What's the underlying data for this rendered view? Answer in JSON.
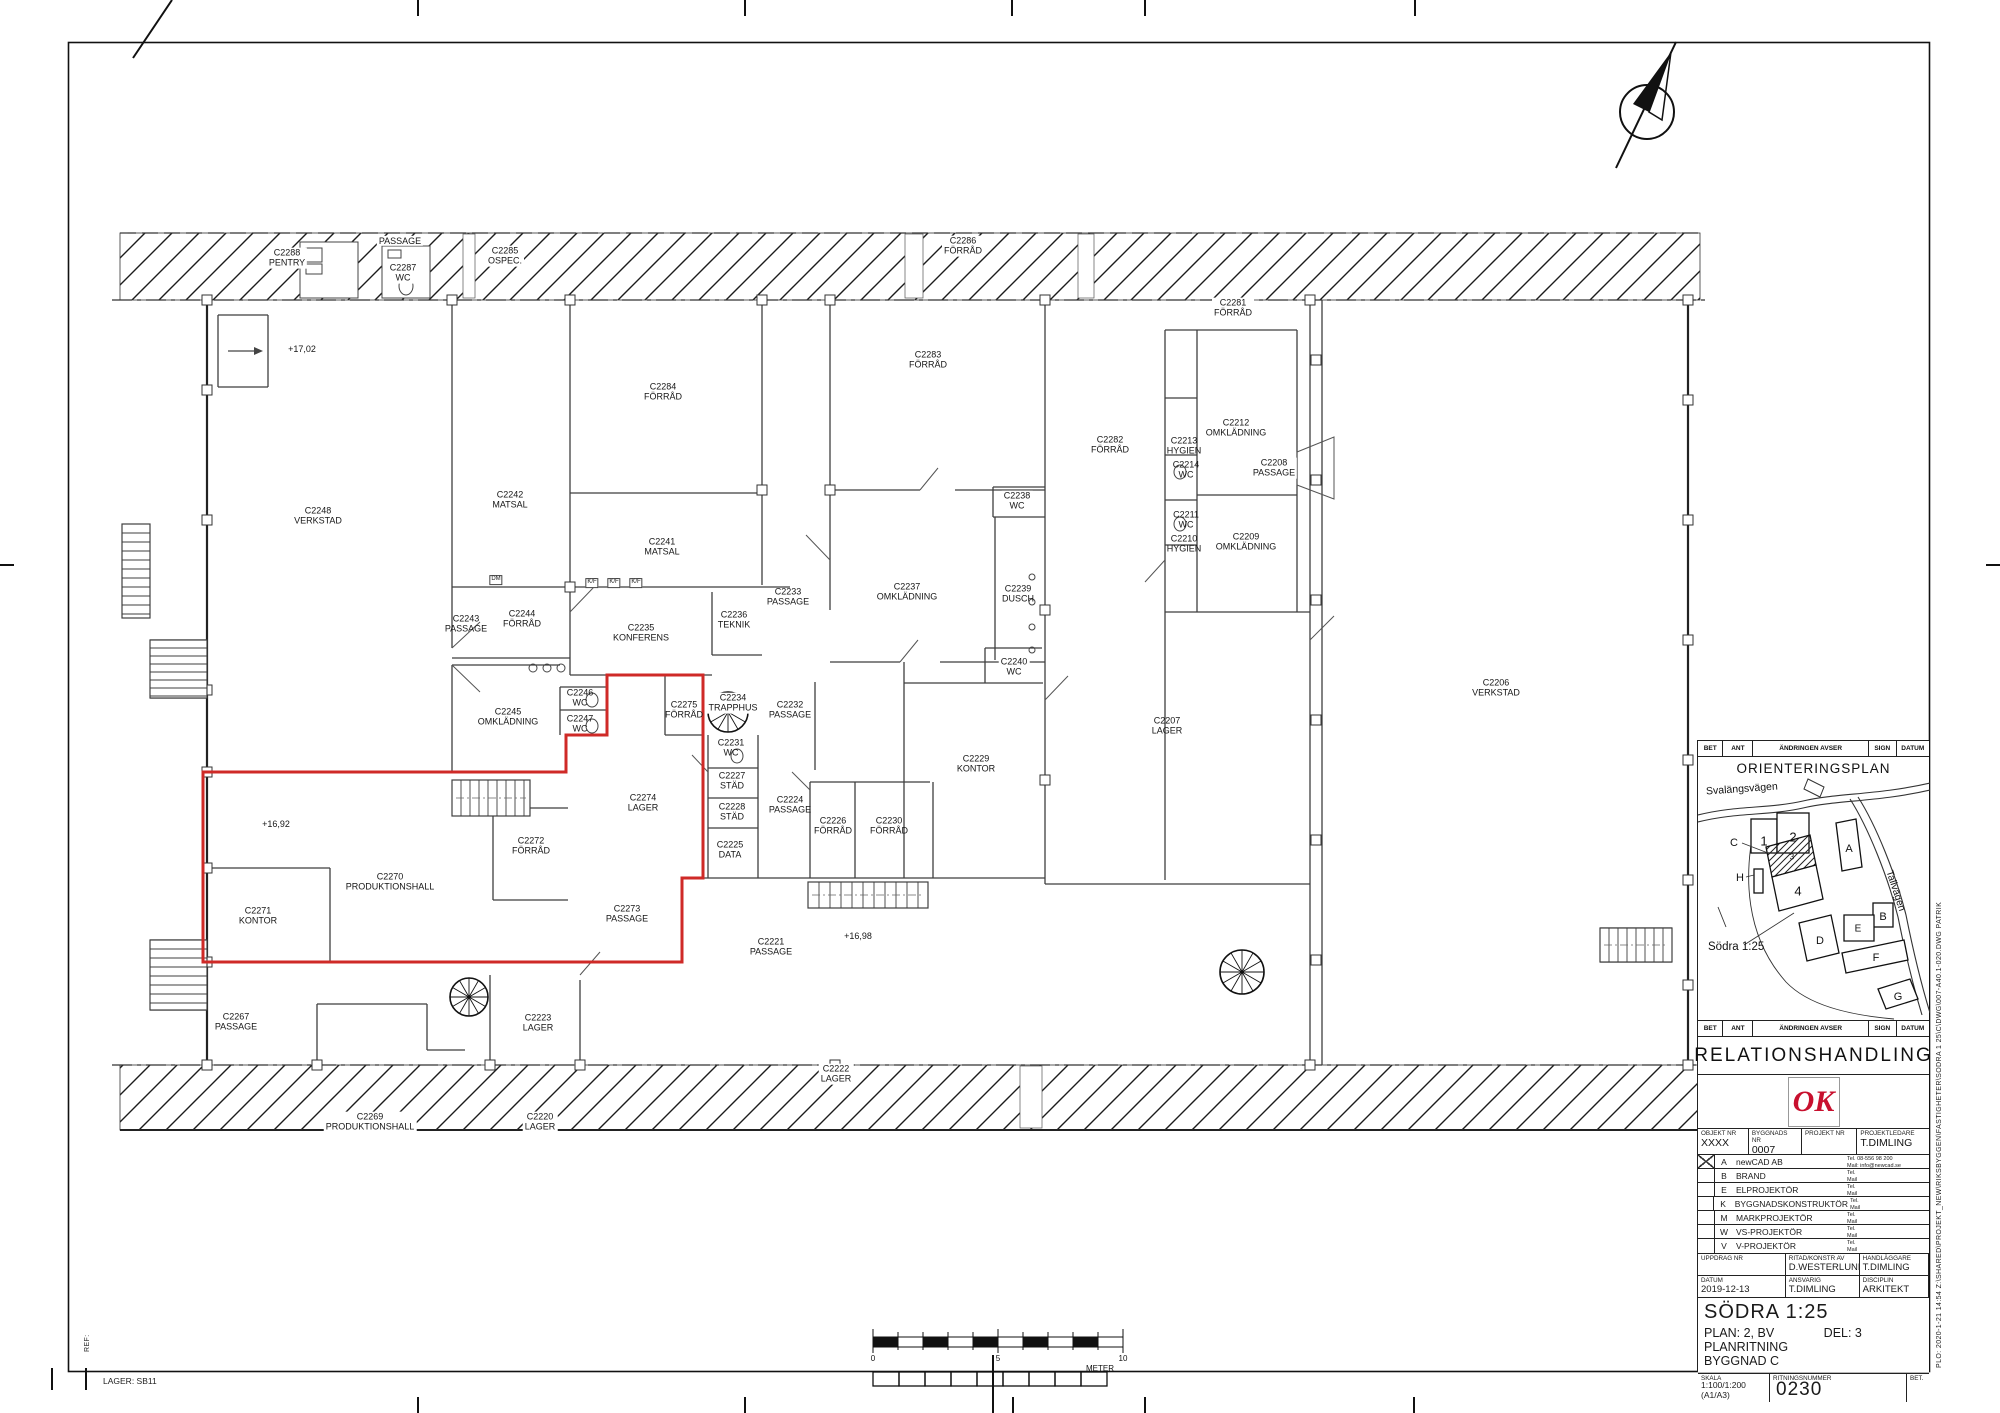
{
  "colors": {
    "highlight": "#cf2a27",
    "ok_red": "#c8102e",
    "wall": "#3f3f3f"
  },
  "rooms": [
    {
      "id": "C2288",
      "name": "PENTRY",
      "x": 287,
      "y": 258,
      "bg": true
    },
    {
      "id": "",
      "name": "PASSAGE",
      "x": 400,
      "y": 241,
      "bg": true
    },
    {
      "id": "C2287",
      "name": "WC",
      "x": 403,
      "y": 273,
      "bg": true
    },
    {
      "id": "C2285",
      "name": "OSPEC.",
      "x": 505,
      "y": 256,
      "bg": true
    },
    {
      "id": "C2286",
      "name": "FÖRRÅD",
      "x": 963,
      "y": 246,
      "bg": true
    },
    {
      "id": "C2281",
      "name": "FÖRRÅD",
      "x": 1233,
      "y": 308,
      "bg": true
    },
    {
      "id": "C2284",
      "name": "FÖRRÅD",
      "x": 663,
      "y": 392
    },
    {
      "id": "C2283",
      "name": "FÖRRÅD",
      "x": 928,
      "y": 360
    },
    {
      "id": "C2282",
      "name": "FÖRRÅD",
      "x": 1110,
      "y": 445
    },
    {
      "id": "C2248",
      "name": "VERKSTAD",
      "x": 318,
      "y": 516
    },
    {
      "id": "C2242",
      "name": "MATSAL",
      "x": 510,
      "y": 500
    },
    {
      "id": "C2241",
      "name": "MATSAL",
      "x": 662,
      "y": 547
    },
    {
      "id": "C2243",
      "name": "PASSAGE",
      "x": 466,
      "y": 624
    },
    {
      "id": "C2244",
      "name": "FÖRRÅD",
      "x": 522,
      "y": 619
    },
    {
      "id": "C2235",
      "name": "KONFERENS",
      "x": 641,
      "y": 633
    },
    {
      "id": "C2236",
      "name": "TEKNIK",
      "x": 734,
      "y": 620
    },
    {
      "id": "C2233",
      "name": "PASSAGE",
      "x": 788,
      "y": 597
    },
    {
      "id": "C2237",
      "name": "OMKLÄDNING",
      "x": 907,
      "y": 592
    },
    {
      "id": "C2239",
      "name": "DUSCH",
      "x": 1018,
      "y": 594
    },
    {
      "id": "C2238",
      "name": "WC",
      "x": 1017,
      "y": 501,
      "bg": true
    },
    {
      "id": "C2240",
      "name": "WC",
      "x": 1014,
      "y": 667,
      "bg": true
    },
    {
      "id": "C2213",
      "name": "HYGIEN",
      "x": 1184,
      "y": 446
    },
    {
      "id": "C2212",
      "name": "OMKLÄDNING",
      "x": 1236,
      "y": 428
    },
    {
      "id": "C2214",
      "name": "WC",
      "x": 1186,
      "y": 470
    },
    {
      "id": "C2208",
      "name": "PASSAGE",
      "x": 1274,
      "y": 468,
      "bg": true
    },
    {
      "id": "C2211",
      "name": "WC",
      "x": 1186,
      "y": 520
    },
    {
      "id": "C2210",
      "name": "HYGIEN",
      "x": 1184,
      "y": 544
    },
    {
      "id": "C2209",
      "name": "OMKLÄDNING",
      "x": 1246,
      "y": 542
    },
    {
      "id": "C2206",
      "name": "VERKSTAD",
      "x": 1496,
      "y": 688
    },
    {
      "id": "C2207",
      "name": "LAGER",
      "x": 1167,
      "y": 726
    },
    {
      "id": "C2229",
      "name": "KONTOR",
      "x": 976,
      "y": 764
    },
    {
      "id": "C2245",
      "name": "OMKLÄDNING",
      "x": 508,
      "y": 717
    },
    {
      "id": "C2246",
      "name": "WC",
      "x": 580,
      "y": 698
    },
    {
      "id": "C2247",
      "name": "WC",
      "x": 580,
      "y": 724
    },
    {
      "id": "C2275",
      "name": "FÖRRÅD",
      "x": 684,
      "y": 710
    },
    {
      "id": "C2234",
      "name": "TRAPPHUS",
      "x": 733,
      "y": 703,
      "bg": true
    },
    {
      "id": "C2231",
      "name": "WC",
      "x": 731,
      "y": 748
    },
    {
      "id": "C2227",
      "name": "STÄD",
      "x": 732,
      "y": 781
    },
    {
      "id": "C2228",
      "name": "STÄD",
      "x": 732,
      "y": 812
    },
    {
      "id": "C2225",
      "name": "DATA",
      "x": 730,
      "y": 850
    },
    {
      "id": "C2232",
      "name": "PASSAGE",
      "x": 790,
      "y": 710
    },
    {
      "id": "C2224",
      "name": "PASSAGE",
      "x": 790,
      "y": 805
    },
    {
      "id": "C2226",
      "name": "FÖRRÅD",
      "x": 833,
      "y": 826
    },
    {
      "id": "C2230",
      "name": "FÖRRÅD",
      "x": 889,
      "y": 826
    },
    {
      "id": "C2274",
      "name": "LAGER",
      "x": 643,
      "y": 803
    },
    {
      "id": "C2272",
      "name": "FÖRRÅD",
      "x": 531,
      "y": 846
    },
    {
      "id": "C2270",
      "name": "PRODUKTIONSHALL",
      "x": 390,
      "y": 882
    },
    {
      "id": "C2271",
      "name": "KONTOR",
      "x": 258,
      "y": 916
    },
    {
      "id": "C2273",
      "name": "PASSAGE",
      "x": 627,
      "y": 914
    },
    {
      "id": "C2221",
      "name": "PASSAGE",
      "x": 771,
      "y": 947
    },
    {
      "id": "C2267",
      "name": "PASSAGE",
      "x": 236,
      "y": 1022
    },
    {
      "id": "C2223",
      "name": "LAGER",
      "x": 538,
      "y": 1023
    },
    {
      "id": "C2222",
      "name": "LAGER",
      "x": 836,
      "y": 1074,
      "bg": true
    },
    {
      "id": "C2269",
      "name": "PRODUKTIONSHALL",
      "x": 370,
      "y": 1122,
      "bg": true
    },
    {
      "id": "C2220",
      "name": "LAGER",
      "x": 540,
      "y": 1122,
      "bg": true
    }
  ],
  "annotations": [
    {
      "t": "+17,02",
      "x": 302,
      "y": 349
    },
    {
      "t": "+16,92",
      "x": 276,
      "y": 824
    },
    {
      "t": "+16,98",
      "x": 858,
      "y": 936
    }
  ],
  "fixtures": [
    {
      "t": "DM",
      "x": 496,
      "y": 580
    },
    {
      "t": "K/F",
      "x": 592,
      "y": 583
    },
    {
      "t": "K/F",
      "x": 614,
      "y": 583
    },
    {
      "t": "K/F",
      "x": 636,
      "y": 583
    }
  ],
  "scalebar": {
    "zero": "0",
    "five": "5",
    "ten": "10",
    "unit": "METER"
  },
  "meta": {
    "lager": "LAGER: SB11",
    "ref": "REF:",
    "plot": "PLO:  2020-1-21   14:54    Z:\\SHARED\\PROJEKT_NEW\\RIKSBYGGEN\\FASTIGHETER\\SODRA 1 25\\C\\DWG\\007-A40.1-020.DWG    PATRIK"
  },
  "titleblock": {
    "rev_header": [
      "BET",
      "ANT",
      "ÄNDRINGEN AVSER",
      "SIGN",
      "DATUM"
    ],
    "orientation": {
      "title": "ORIENTERINGSPLAN",
      "road1": "Svalängsvägen",
      "road2": "Tallvägen",
      "area": "Södra 1:25",
      "buildings": [
        {
          "t": "1",
          "x": 66,
          "y": 84,
          "s": 13
        },
        {
          "t": "2",
          "x": 95,
          "y": 80,
          "s": 13
        },
        {
          "t": "3",
          "x": 94,
          "y": 100,
          "s": 8
        },
        {
          "t": "4",
          "x": 100,
          "y": 134,
          "s": 13
        },
        {
          "t": "A",
          "x": 151,
          "y": 92,
          "s": 11
        },
        {
          "t": "B",
          "x": 185,
          "y": 160,
          "s": 11
        },
        {
          "t": "C",
          "x": 36,
          "y": 86,
          "s": 11
        },
        {
          "t": "D",
          "x": 122,
          "y": 184,
          "s": 11
        },
        {
          "t": "E",
          "x": 160,
          "y": 172,
          "s": 10
        },
        {
          "t": "F",
          "x": 178,
          "y": 201,
          "s": 11
        },
        {
          "t": "G",
          "x": 200,
          "y": 240,
          "s": 11
        },
        {
          "t": "H",
          "x": 42,
          "y": 121,
          "s": 11
        }
      ]
    },
    "doc_type": "RELATIONSHANDLING",
    "logo": "OK",
    "fields": [
      {
        "label": "OBJEKT NR",
        "value": "XXXX"
      },
      {
        "label": "BYGGNADS NR",
        "value": "0007"
      },
      {
        "label": "PROJEKT NR",
        "value": ""
      },
      {
        "label": "PROJEKTLEDARE",
        "value": "T.DIMLING"
      }
    ],
    "consultants": [
      {
        "code": "A",
        "name": "newCAD AB",
        "tel": "Tel. 08-556 98 200",
        "mail": "Mail: info@newcad.se",
        "x": true
      },
      {
        "code": "B",
        "name": "BRAND",
        "tel": "Tel.",
        "mail": "Mail",
        "x": false
      },
      {
        "code": "E",
        "name": "ELPROJEKTÖR",
        "tel": "Tel.",
        "mail": "Mail",
        "x": false
      },
      {
        "code": "K",
        "name": "BYGGNADSKONSTRUKTÖR",
        "tel": "Tel.",
        "mail": "Mail",
        "x": false
      },
      {
        "code": "M",
        "name": "MARKPROJEKTÖR",
        "tel": "Tel.",
        "mail": "Mail",
        "x": false
      },
      {
        "code": "W",
        "name": "VS-PROJEKTÖR",
        "tel": "Tel.",
        "mail": "Mail",
        "x": false
      },
      {
        "code": "V",
        "name": "V-PROJEKTÖR",
        "tel": "Tel.",
        "mail": "Mail",
        "x": false
      }
    ],
    "info": [
      {
        "label": "UPPDRAG NR",
        "value": ""
      },
      {
        "label": "RITAD/KONSTR AV",
        "value": "D.WESTERLUND"
      },
      {
        "label": "HANDLÄGGARE",
        "value": "T.DIMLING"
      },
      {
        "label": "DATUM",
        "value": "2019-12-13"
      },
      {
        "label": "ANSVARIG",
        "value": "T.DIMLING"
      },
      {
        "label": "DISCIPLIN",
        "value": "ARKITEKT"
      }
    ],
    "title": {
      "line1": "SÖDRA 1:25",
      "line2a": "PLAN: 2, BV",
      "line2b": "DEL: 3",
      "line3": "PLANRITNING",
      "line4": "BYGGNAD C"
    },
    "bottom": {
      "skala_label": "SKALA",
      "skala": "1:100/1:200 (A1/A3)",
      "nr_label": "RITNINGSNUMMER",
      "nr": "0007-A40.1-0230",
      "bet_label": "BET."
    }
  }
}
